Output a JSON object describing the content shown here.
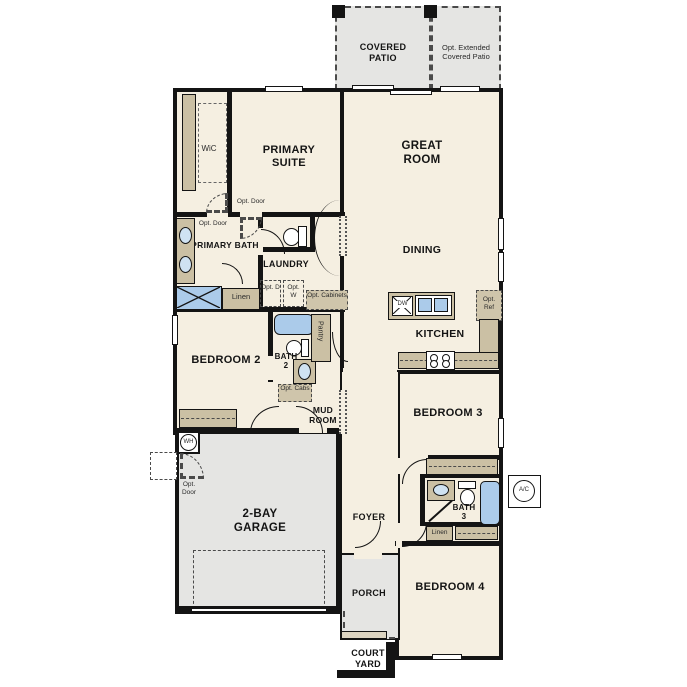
{
  "rooms": {
    "covered_patio": "COVERED PATIO",
    "opt_extended_patio": "Opt. Extended Covered Patio",
    "wic": "WiC",
    "primary_suite": "PRIMARY SUITE",
    "great_room": "GREAT ROOM",
    "primary_bath": "PRIMARY BATH",
    "laundry": "LAUNDRY",
    "dining": "DINING",
    "kitchen": "KITCHEN",
    "bedroom_2": "BEDROOM 2",
    "bath_2": "BATH 2",
    "pantry": "Pantry",
    "mud_room": "MUD ROOM",
    "bedroom_3": "BEDROOM 3",
    "bath_3": "BATH 3",
    "bedroom_4": "BEDROOM 4",
    "garage": "2-BAY GARAGE",
    "foyer": "FOYER",
    "porch": "PORCH",
    "court_yard": "COURT YARD"
  },
  "features": {
    "opt_door": "Opt. Door",
    "linen": "Linen",
    "opt_d": "Opt. D",
    "opt_w": "Opt. W",
    "opt_cabinets": "Opt. Cabinets",
    "opt_cabs": "Opt. Cabs",
    "opt_ref": "Opt. Ref",
    "dw": "DW",
    "wh": "WH",
    "ac": "A/C"
  },
  "colors": {
    "wall": "#141414",
    "room_fill": "#f5efe1",
    "outdoor_fill": "#e5e5e3",
    "cabinet_fill": "#cbc0a4",
    "fixture_blue": "#abcbea"
  }
}
